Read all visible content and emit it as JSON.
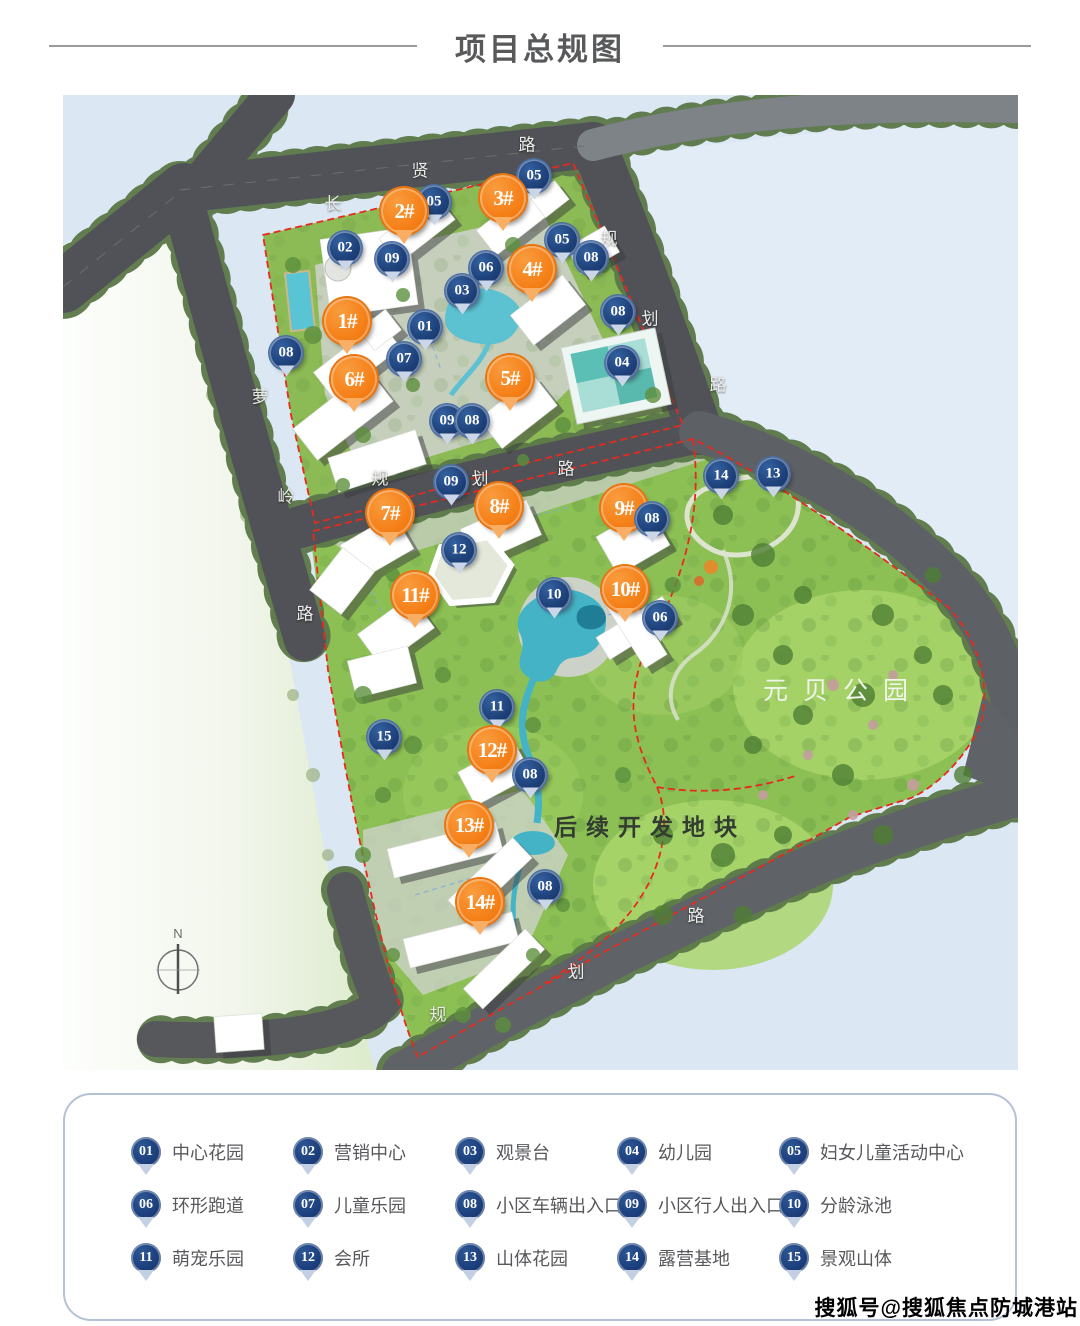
{
  "title": "项目总规图",
  "watermark": "搜狐号@搜狐焦点防城港站",
  "colors": {
    "accent_orange": "#f57f17",
    "pin_blue": "#1c3e7c",
    "boundary_red": "#e62b1e",
    "road_gray": "#515257",
    "park_green": "#8cc054",
    "water_blue": "#dbe7f3",
    "title_gray": "#58595b"
  },
  "map": {
    "compass": {
      "label": "N"
    },
    "area_labels": [
      {
        "text": "元贝公园",
        "style": "light",
        "x": 843,
        "y": 689
      },
      {
        "text": "后续开发地块",
        "style": "dark",
        "x": 650,
        "y": 825
      }
    ],
    "road_names": [
      {
        "name": "长贤路",
        "chars": [
          {
            "ch": "长",
            "x": 333,
            "y": 202
          },
          {
            "ch": "贤",
            "x": 420,
            "y": 169
          },
          {
            "ch": "路",
            "x": 527,
            "y": 143
          }
        ]
      },
      {
        "name": "规划路",
        "chars": [
          {
            "ch": "规",
            "x": 609,
            "y": 237
          },
          {
            "ch": "划",
            "x": 650,
            "y": 317
          },
          {
            "ch": "路",
            "x": 718,
            "y": 383
          }
        ]
      },
      {
        "name": "萝岭路",
        "chars": [
          {
            "ch": "萝",
            "x": 260,
            "y": 395
          },
          {
            "ch": "岭",
            "x": 286,
            "y": 495
          },
          {
            "ch": "路",
            "x": 305,
            "y": 612
          }
        ]
      },
      {
        "name": "规划路",
        "chars": [
          {
            "ch": "规",
            "x": 380,
            "y": 477
          },
          {
            "ch": "划",
            "x": 480,
            "y": 477
          },
          {
            "ch": "路",
            "x": 566,
            "y": 467
          }
        ]
      },
      {
        "name": "规划路",
        "chars": [
          {
            "ch": "规",
            "x": 438,
            "y": 1013
          },
          {
            "ch": "划",
            "x": 576,
            "y": 970
          },
          {
            "ch": "路",
            "x": 696,
            "y": 914
          }
        ]
      }
    ],
    "building_pins": [
      {
        "label": "1#",
        "x": 347,
        "y": 321
      },
      {
        "label": "2#",
        "x": 404,
        "y": 211
      },
      {
        "label": "3#",
        "x": 503,
        "y": 198
      },
      {
        "label": "4#",
        "x": 532,
        "y": 269
      },
      {
        "label": "5#",
        "x": 510,
        "y": 378
      },
      {
        "label": "6#",
        "x": 354,
        "y": 379
      },
      {
        "label": "7#",
        "x": 390,
        "y": 513
      },
      {
        "label": "8#",
        "x": 499,
        "y": 506
      },
      {
        "label": "9#",
        "x": 624,
        "y": 508
      },
      {
        "label": "10#",
        "x": 625,
        "y": 589
      },
      {
        "label": "11#",
        "x": 415,
        "y": 595
      },
      {
        "label": "12#",
        "x": 492,
        "y": 750
      },
      {
        "label": "13#",
        "x": 469,
        "y": 825
      },
      {
        "label": "14#",
        "x": 480,
        "y": 902
      }
    ],
    "amenity_pins": [
      {
        "label": "05",
        "x": 534,
        "y": 176
      },
      {
        "label": "05",
        "x": 434,
        "y": 202
      },
      {
        "label": "02",
        "x": 345,
        "y": 248
      },
      {
        "label": "09",
        "x": 392,
        "y": 259
      },
      {
        "label": "05",
        "x": 562,
        "y": 240
      },
      {
        "label": "08",
        "x": 591,
        "y": 258
      },
      {
        "label": "06",
        "x": 486,
        "y": 268
      },
      {
        "label": "03",
        "x": 462,
        "y": 291
      },
      {
        "label": "08",
        "x": 618,
        "y": 312
      },
      {
        "label": "01",
        "x": 425,
        "y": 327
      },
      {
        "label": "08",
        "x": 286,
        "y": 353
      },
      {
        "label": "07",
        "x": 404,
        "y": 359
      },
      {
        "label": "04",
        "x": 622,
        "y": 363
      },
      {
        "label": "09",
        "x": 447,
        "y": 421
      },
      {
        "label": "08",
        "x": 472,
        "y": 421
      },
      {
        "label": "09",
        "x": 451,
        "y": 482
      },
      {
        "label": "14",
        "x": 721,
        "y": 476
      },
      {
        "label": "13",
        "x": 773,
        "y": 474
      },
      {
        "label": "08",
        "x": 652,
        "y": 519
      },
      {
        "label": "12",
        "x": 459,
        "y": 550
      },
      {
        "label": "10",
        "x": 554,
        "y": 595
      },
      {
        "label": "06",
        "x": 660,
        "y": 618
      },
      {
        "label": "11",
        "x": 497,
        "y": 707
      },
      {
        "label": "15",
        "x": 384,
        "y": 737
      },
      {
        "label": "08",
        "x": 530,
        "y": 775
      },
      {
        "label": "08",
        "x": 545,
        "y": 887
      }
    ]
  },
  "legend": {
    "items": [
      {
        "num": "01",
        "label": "中心花园"
      },
      {
        "num": "02",
        "label": "营销中心"
      },
      {
        "num": "03",
        "label": "观景台"
      },
      {
        "num": "04",
        "label": "幼儿园"
      },
      {
        "num": "05",
        "label": "妇女儿童活动中心"
      },
      {
        "num": "06",
        "label": "环形跑道"
      },
      {
        "num": "07",
        "label": "儿童乐园"
      },
      {
        "num": "08",
        "label": "小区车辆出入口"
      },
      {
        "num": "09",
        "label": "小区行人出入口"
      },
      {
        "num": "10",
        "label": "分龄泳池"
      },
      {
        "num": "11",
        "label": "萌宠乐园"
      },
      {
        "num": "12",
        "label": "会所"
      },
      {
        "num": "13",
        "label": "山体花园"
      },
      {
        "num": "14",
        "label": "露营基地"
      },
      {
        "num": "15",
        "label": "景观山体"
      }
    ]
  }
}
